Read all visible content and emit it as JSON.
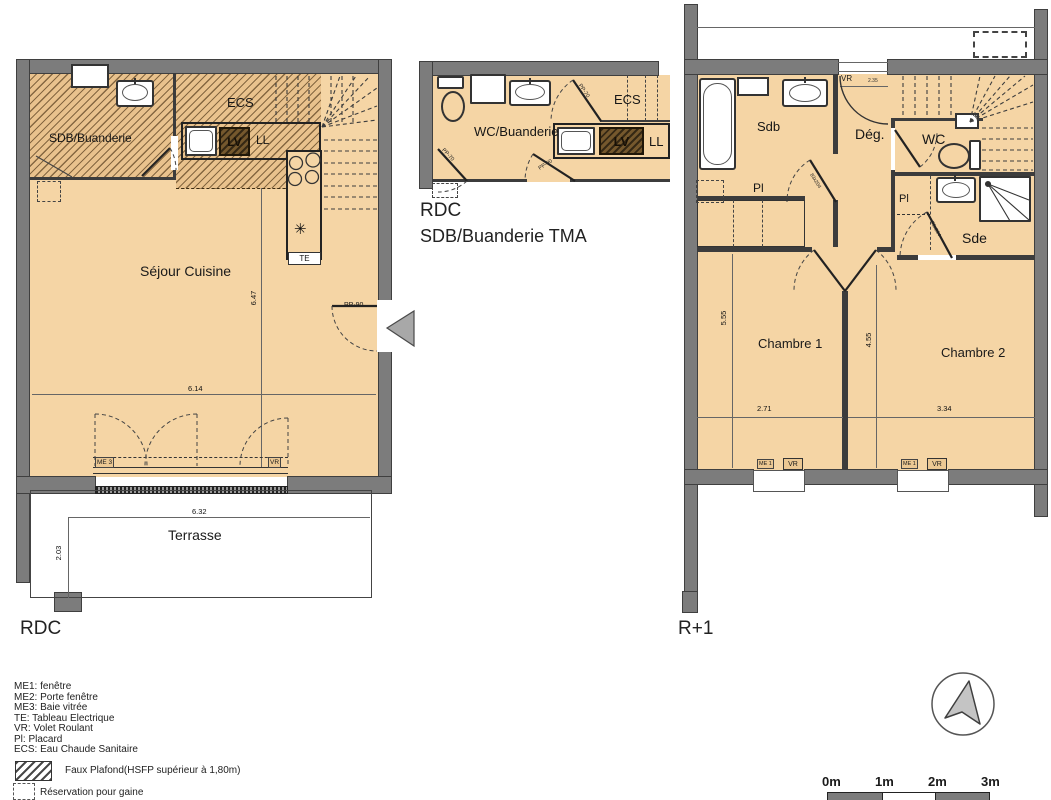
{
  "rdc": {
    "title": "RDC",
    "room_sdb": "SDB/Buanderie",
    "room_sejour": "Séjour Cuisine",
    "room_terrasse": "Terrasse",
    "ecs": "ECS",
    "lv": "LV",
    "ll": "LL",
    "te": "TE",
    "door_entry": "PP-90",
    "me3": "ME 3",
    "vr_window": "VR",
    "dim_room_h": "6.47",
    "dim_room_w": "6.14",
    "dim_terrasse_w": "6.32",
    "dim_terrasse_d": "2.03"
  },
  "tma": {
    "title_line1": "RDC",
    "title_line2": "SDB/Buanderie TMA",
    "room_wc": "WC/Buanderie",
    "ecs": "ECS",
    "lv": "LV",
    "ll": "LL",
    "door_left": "PP-70",
    "door_mid": "PP-90",
    "door_right": "PP-70"
  },
  "r1": {
    "title": "R+1",
    "room_sdb": "Sdb",
    "room_deg": "Dég.",
    "room_wc": "WC",
    "room_sde": "Sde",
    "room_ch1": "Chambre 1",
    "room_ch2": "Chambre 2",
    "pl_left": "Pl",
    "pl_right": "Pl",
    "vr_top": "VR",
    "vr_top_dim": "2.35",
    "door_sdb": "83x204",
    "door_sde": "70x204",
    "dim_ch1_h": "5.55",
    "dim_mid_h": "4.55",
    "dim_ch1_w": "2.71",
    "dim_ch2_w": "3.34",
    "win1_me": "ME 1",
    "win1_vr": "VR",
    "win2_me": "ME 1",
    "win2_vr": "VR"
  },
  "legend": {
    "items": [
      "ME1: fenêtre",
      "ME2: Porte fenêtre",
      "ME3: Baie vitrée",
      "TE: Tableau Electrique",
      "VR: Volet Roulant",
      "Pl: Placard",
      "ECS: Eau Chaude Sanitaire"
    ],
    "faux_plafond": "Faux Plafond(HSFP supérieur à 1,80m)",
    "reservation": "Réservation pour gaine"
  },
  "scale_bar": {
    "labels": [
      "0m",
      "1m",
      "2m",
      "3m"
    ]
  },
  "symbols": {
    "cooktop_star": "✳"
  },
  "colors": {
    "wall": "#7c7c7c",
    "floor": "#f5d5a5",
    "hatch_bg": "#e9c28d",
    "dark_line": "#3c3c3c"
  }
}
